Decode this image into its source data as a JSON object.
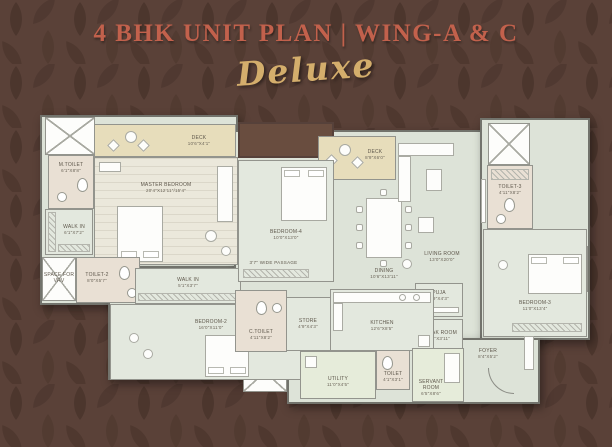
{
  "header": {
    "title": "4 BHK UNIT PLAN | WING-A & C",
    "subtitle": "Deluxe"
  },
  "colors": {
    "background": "#5a4138",
    "title": "#c2614c",
    "subtitle_gold": "#d4ae6c",
    "floor": "#dde3d8",
    "deck": "#e7ddbb",
    "toilet_floor": "#e9e0d4",
    "wall": "#93948d"
  },
  "plan": {
    "passage": {
      "name": "3'7\" WIDE PASSAGE"
    },
    "rooms": {
      "master": {
        "name": "MASTER BEDROOM",
        "dims": "20'4\"X12'11\"/15'4\""
      },
      "deck1": {
        "name": "DECK",
        "dims": "10'6\"X4'1\""
      },
      "mtoilet": {
        "name": "M.TOILET",
        "dims": "6'1\"X8'8\""
      },
      "walkin1": {
        "name": "WALK IN",
        "dims": "6'1\"X7'2\""
      },
      "vrv": {
        "name": "SPACE FOR VRV",
        "dims": ""
      },
      "toilet2": {
        "name": "TOILET-2",
        "dims": "8'0\"X5'7\""
      },
      "walkin2": {
        "name": "WALK IN",
        "dims": "5'1\"X3'7\""
      },
      "bedroom2": {
        "name": "BEDROOM-2",
        "dims": "16'0\"X11'0\""
      },
      "bedroom4": {
        "name": "BEDROOM-4",
        "dims": "10'0\"X13'0\""
      },
      "deck2": {
        "name": "DECK",
        "dims": "8'9\"X6'0\""
      },
      "dining": {
        "name": "DINING",
        "dims": "10'6\"X13'11\""
      },
      "living": {
        "name": "LIVING ROOM",
        "dims": "13'0\"X20'0\""
      },
      "toilet3": {
        "name": "TOILET-3",
        "dims": "4'11\"X8'2\""
      },
      "bedroom3": {
        "name": "BEDROOM-3",
        "dims": "11'0\"X13'4\""
      },
      "puja": {
        "name": "PUJA",
        "dims": "5'9\"X4'3\""
      },
      "cloak": {
        "name": "CLOAK ROOM",
        "dims": "6'4\"X3'11\""
      },
      "kitchen": {
        "name": "KITCHEN",
        "dims": "12'6\"X8'5\""
      },
      "store": {
        "name": "STORE",
        "dims": "4'9\"X4'3\""
      },
      "ctoilet": {
        "name": "C.TOILET",
        "dims": "4'11\"X8'2\""
      },
      "utility": {
        "name": "UTILITY",
        "dims": "11'0\"X4'5\""
      },
      "toilet_s": {
        "name": "TOILET",
        "dims": "4'1\"X3'1\""
      },
      "servant": {
        "name": "SERVANT ROOM",
        "dims": "6'5\"X8'6\""
      },
      "foyer": {
        "name": "FOYER",
        "dims": "8'4\"X5'2\""
      }
    }
  }
}
